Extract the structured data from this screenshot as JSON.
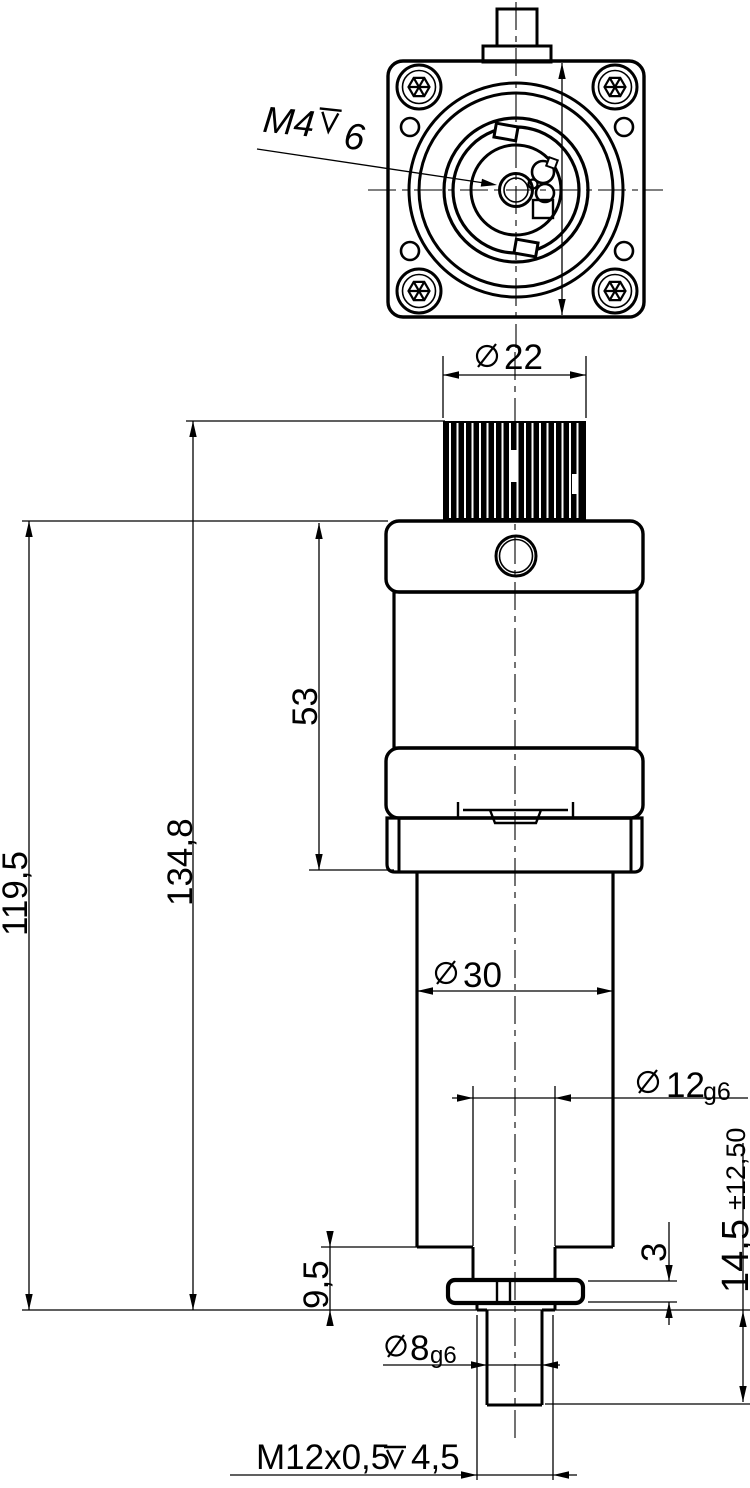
{
  "document": {
    "type": "technical-dimension-drawing",
    "background": "#ffffff",
    "line_color": "#000000"
  },
  "dimensions": {
    "flange_thread": {
      "thread": "M4",
      "symbol": "depth",
      "depth": "6"
    },
    "connector_diameter": {
      "symbol": "diameter",
      "value": "22"
    },
    "overall_length": {
      "value": "134,8"
    },
    "length_to_flange": {
      "value": "119,5"
    },
    "motor_length": {
      "value": "53"
    },
    "housing_diameter": {
      "symbol": "diameter",
      "value": "30"
    },
    "shaft_diameter": {
      "symbol": "diameter",
      "value": "12",
      "fit": "g6"
    },
    "shoulder_length": {
      "value": "9,5"
    },
    "nut_thickness": {
      "value": "3"
    },
    "stroke_length": {
      "value": "14,5",
      "tolerance": "±12,50"
    },
    "spindle_diameter": {
      "symbol": "diameter",
      "value": "8",
      "fit": "g6"
    },
    "spindle_thread": {
      "thread": "M12x0,5",
      "symbol": "depth",
      "depth": "4,5"
    }
  }
}
